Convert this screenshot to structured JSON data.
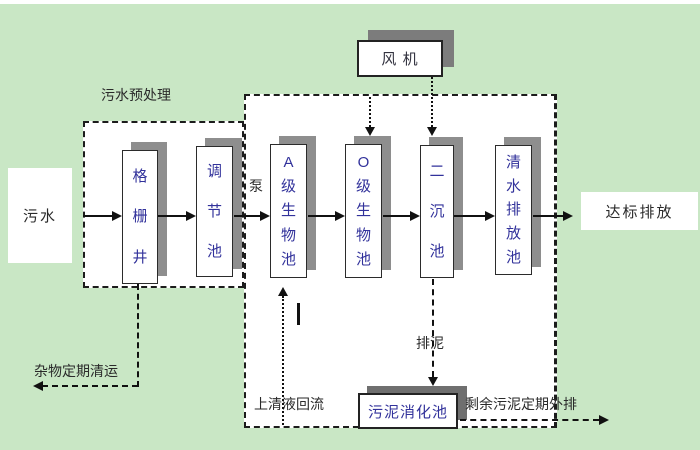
{
  "diagram": {
    "labels": {
      "influent": "污水",
      "pretreatment_section": "污水预处理",
      "pump": "泵",
      "fan": "风 机",
      "effluent": "达标排放",
      "debris_removal": "杂物定期清运",
      "supernatant_return": "上清液回流",
      "sludge_discharge": "排泥",
      "excess_sludge_out": "剩余污泥定期外排"
    },
    "tanks": {
      "grid_well": "格栅井",
      "regulating_tank": "调节池",
      "a_bio_tank": "A级生物池",
      "o_bio_tank": "O级生物池",
      "secondary_clarifier": "二沉池",
      "clean_water_discharge_tank": "清水排放池",
      "sludge_digester": "污泥消化池"
    },
    "colors": {
      "background": "#c9e7c5",
      "zone_fill": "#ffffff",
      "tank_text": "#32329b",
      "label_text": "#2a2a2a",
      "shadow": "#8e8e8e",
      "shadow_dark": "#6f6f6f",
      "line": "#111111"
    }
  }
}
